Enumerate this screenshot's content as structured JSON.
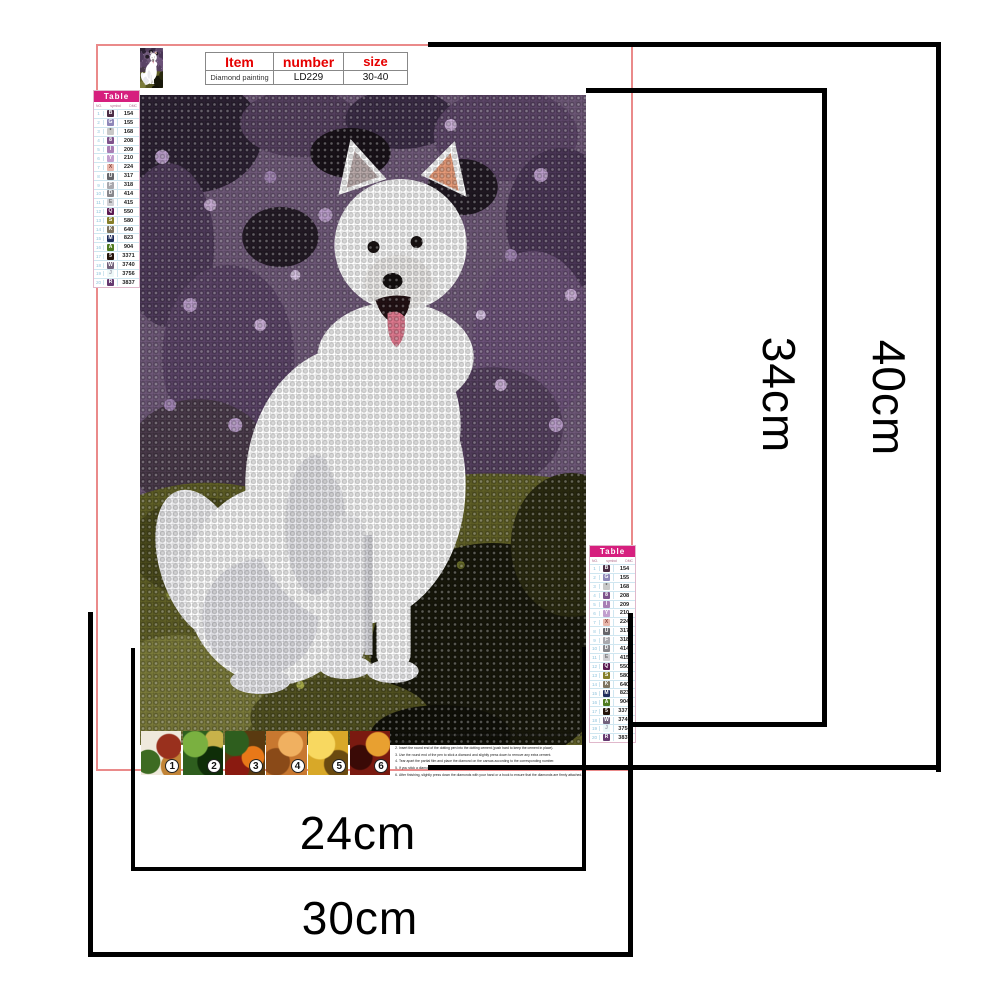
{
  "product": {
    "title_row": [
      "Item",
      "number",
      "size"
    ],
    "value_row": [
      "Diamond painting",
      "LD229",
      "30-40"
    ]
  },
  "color_table": {
    "title": "Table",
    "columns": [
      "NO.",
      "symbol",
      "DMC"
    ],
    "rows": [
      {
        "no": "1",
        "symbol": "B",
        "dmc": "154",
        "bg": "#4b2d45",
        "fg": "#ffffff"
      },
      {
        "no": "2",
        "symbol": "G",
        "dmc": "155",
        "bg": "#8e87b8",
        "fg": "#ffffff"
      },
      {
        "no": "3",
        "symbol": "*",
        "dmc": "168",
        "bg": "#c8c8c8",
        "fg": "#555555"
      },
      {
        "no": "4",
        "symbol": "8",
        "dmc": "208",
        "bg": "#7e538c",
        "fg": "#ffffff"
      },
      {
        "no": "5",
        "symbol": "I",
        "dmc": "209",
        "bg": "#a87fb5",
        "fg": "#ffffff"
      },
      {
        "no": "6",
        "symbol": "Y",
        "dmc": "210",
        "bg": "#c29fce",
        "fg": "#ffffff"
      },
      {
        "no": "7",
        "symbol": "X",
        "dmc": "224",
        "bg": "#e8b7ab",
        "fg": "#8a4a42"
      },
      {
        "no": "8",
        "symbol": "U",
        "dmc": "317",
        "bg": "#66666b",
        "fg": "#ffffff"
      },
      {
        "no": "9",
        "symbol": "F",
        "dmc": "318",
        "bg": "#a8a8ad",
        "fg": "#ffffff"
      },
      {
        "no": "10",
        "symbol": "D",
        "dmc": "414",
        "bg": "#87878c",
        "fg": "#ffffff"
      },
      {
        "no": "11",
        "symbol": "E",
        "dmc": "415",
        "bg": "#d0d0d5",
        "fg": "#777777"
      },
      {
        "no": "12",
        "symbol": "Q",
        "dmc": "550",
        "bg": "#5a1a52",
        "fg": "#ffffff"
      },
      {
        "no": "13",
        "symbol": "S",
        "dmc": "580",
        "bg": "#857f2a",
        "fg": "#ffffff"
      },
      {
        "no": "14",
        "symbol": "K",
        "dmc": "640",
        "bg": "#7d7460",
        "fg": "#ffffff"
      },
      {
        "no": "15",
        "symbol": "M",
        "dmc": "823",
        "bg": "#1f2d5c",
        "fg": "#ffffff"
      },
      {
        "no": "16",
        "symbol": "A",
        "dmc": "904",
        "bg": "#4e7a1f",
        "fg": "#ffffff"
      },
      {
        "no": "17",
        "symbol": "5",
        "dmc": "3371",
        "bg": "#241309",
        "fg": "#ffffff"
      },
      {
        "no": "18",
        "symbol": "W",
        "dmc": "3740",
        "bg": "#72617c",
        "fg": "#ffffff"
      },
      {
        "no": "19",
        "symbol": "J",
        "dmc": "3756",
        "bg": "#edf8f8",
        "fg": "#9999aa"
      },
      {
        "no": "20",
        "symbol": "R",
        "dmc": "3837",
        "bg": "#663a70",
        "fg": "#ffffff"
      }
    ]
  },
  "measurements": {
    "inner_width": "24cm",
    "outer_width": "30cm",
    "inner_height": "34cm",
    "outer_height": "40cm"
  },
  "instructions": [
    {
      "n": "1",
      "text": "Refer to the comparison table on the canvas to identify each diamond number and the corresponding printed number on the canvas."
    },
    {
      "n": "2",
      "text": "Insert the round end of the dotting pen into the dotting cement (push hard to keep the cement in place)."
    },
    {
      "n": "3",
      "text": "Use the round end of the pen to stick a diamond and slightly press down to remove any extra cement."
    },
    {
      "n": "4",
      "text": "Tear apart the partial film and place the diamond on the canvas according to the corresponding number."
    },
    {
      "n": "5",
      "text": "If you stick a diamond to a wrong area on the painting, remove the diamond with tweezers."
    },
    {
      "n": "6",
      "text": "After finishing, slightly press down the diamonds with your hand or a book to ensure that the diamonds are firmly attached."
    }
  ],
  "steps": {
    "numbers": [
      "1",
      "2",
      "3",
      "4",
      "5",
      "6"
    ]
  },
  "colors": {
    "accent_red": "#e60000",
    "frame_red": "#ea8a8a",
    "table_header_bg": "#d61f7e",
    "measure_line": "#000000",
    "background_purple": "#6e5878",
    "background_green": "#5f5f26",
    "dog_white": "#ffffff",
    "tongue_pink": "#e0798f"
  }
}
